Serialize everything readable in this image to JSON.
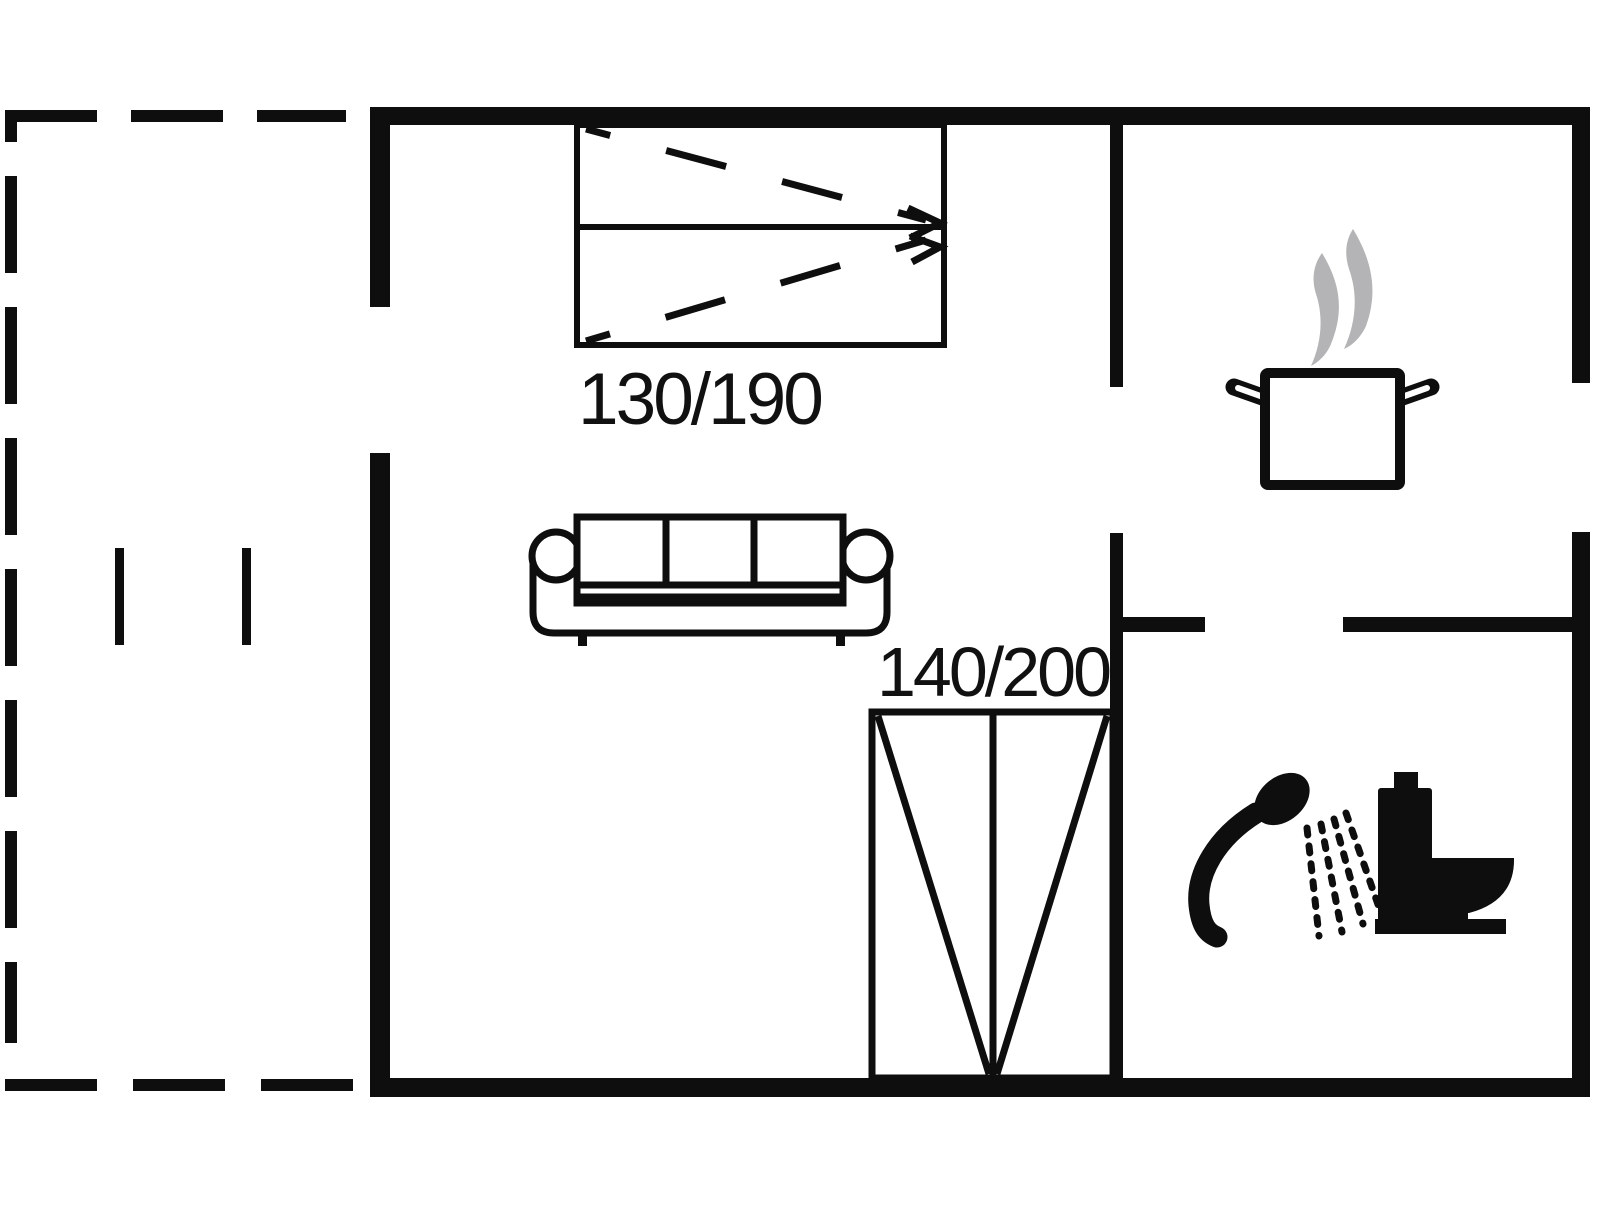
{
  "floor_plan": {
    "bed_labels": {
      "top_bed": "130/190",
      "bottom_bed": "140/200"
    },
    "furniture": [
      "double-bed-top",
      "sofa",
      "double-bed-bottom"
    ],
    "fixture_icons": [
      "cooking-pot-icon",
      "steam-icon",
      "shower-head-icon",
      "toilet-icon"
    ],
    "colors": {
      "ink": "#0e0e0e",
      "steam_gray": "#b4b4b6",
      "background": "#ffffff"
    }
  }
}
